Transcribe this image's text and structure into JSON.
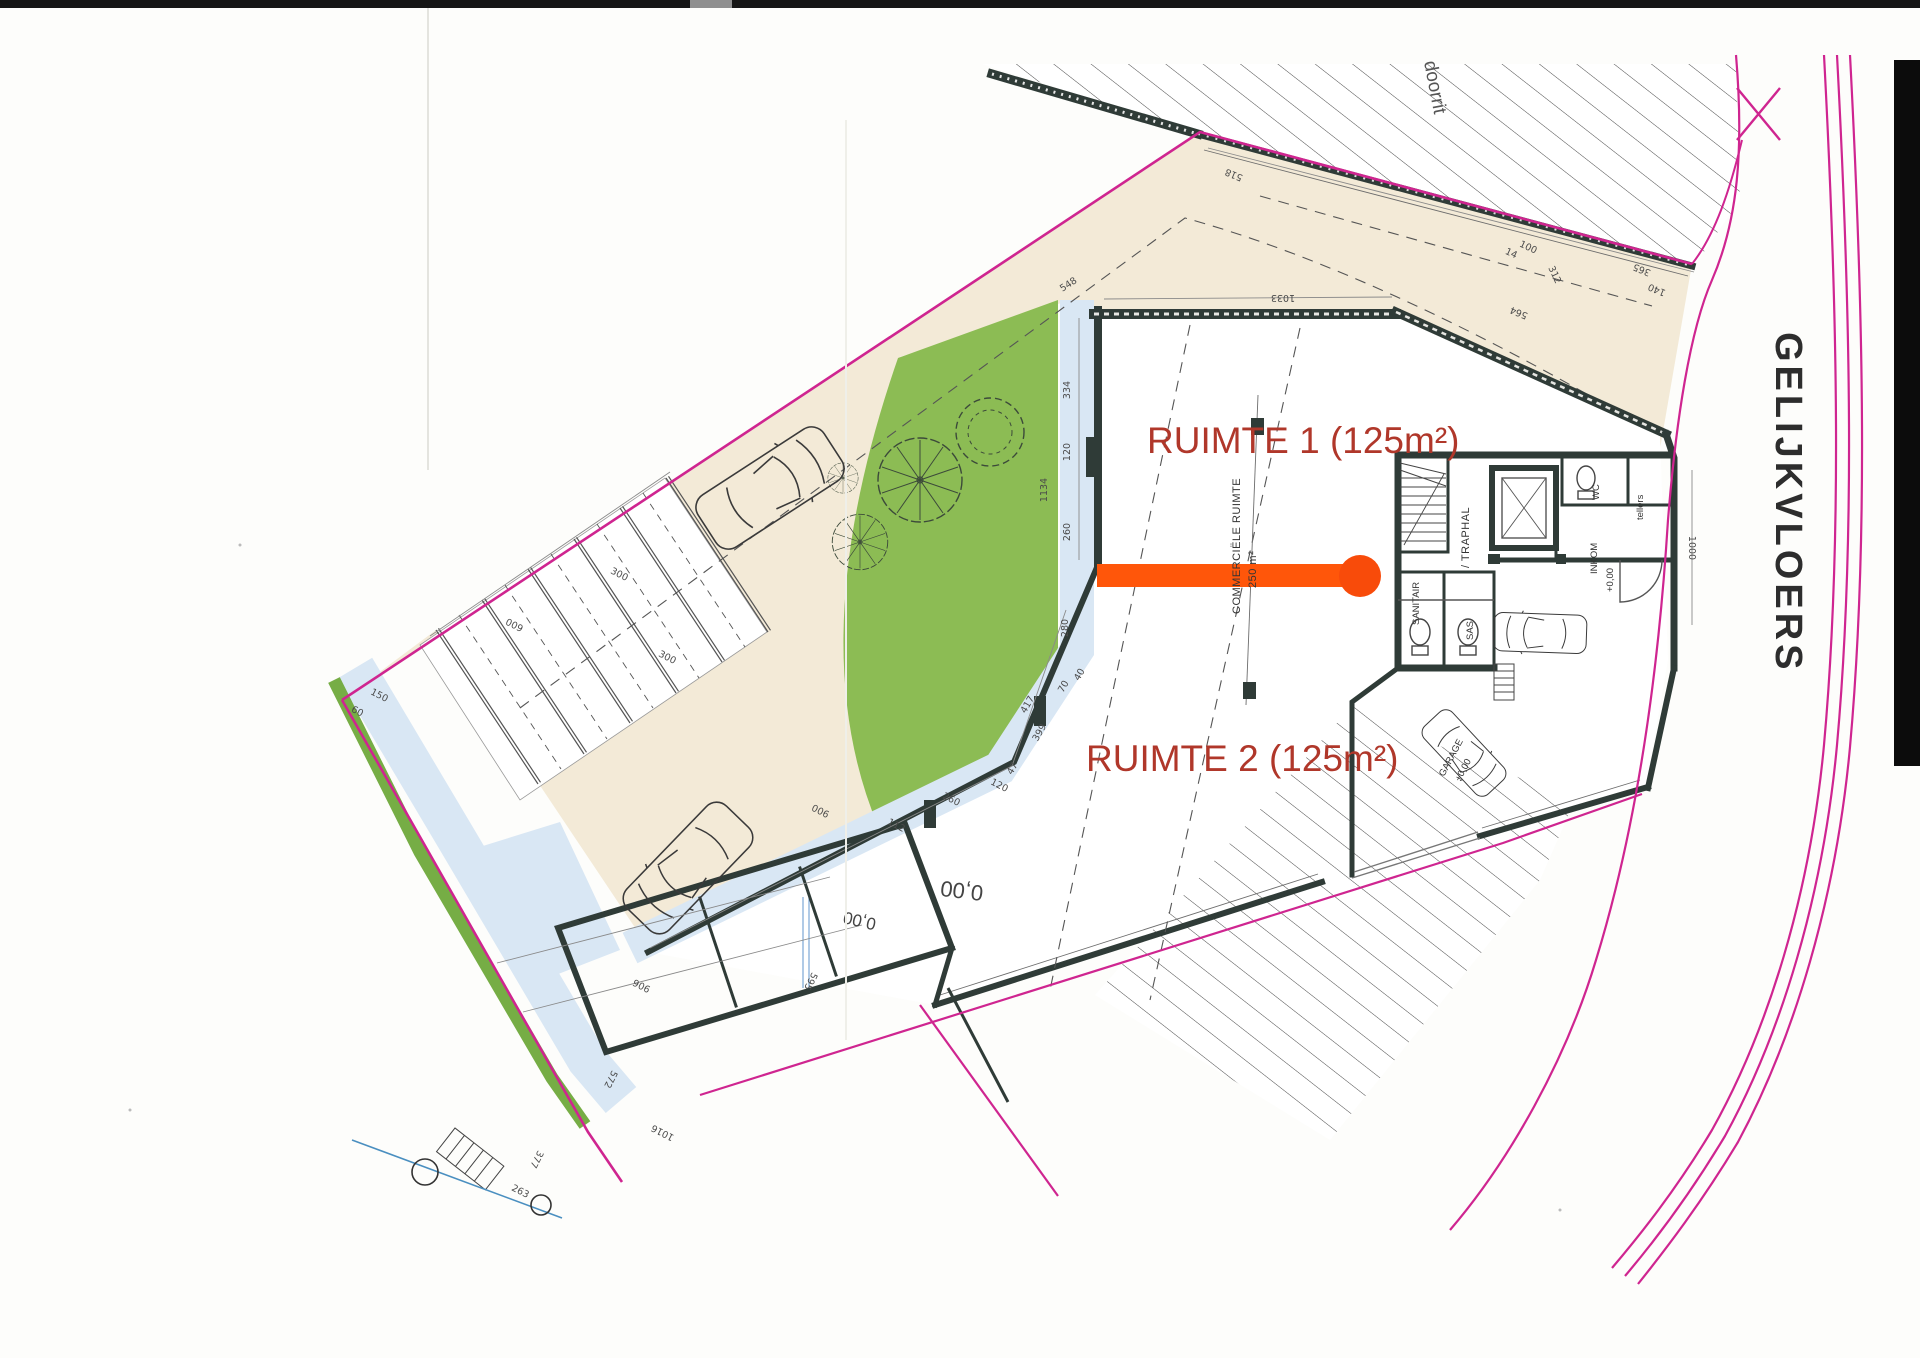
{
  "sheet": {
    "floor_title": "GELIJKVLOERS",
    "driveway_label": "doorrit"
  },
  "spaces": {
    "ruimte1": "RUIMTE 1 (125m²)",
    "ruimte2": "RUIMTE 2 (125m²)",
    "commercial_line1": "COMMERCIËLE RUIMTE",
    "commercial_line2": "250 m²",
    "traphal": "/ TRAPHAL",
    "sanitair": "SANITAIR",
    "sas": "SAS",
    "wc": "WC",
    "inkom": "INKOM",
    "inkom_level": "+0,00",
    "tellers": "tellers",
    "garage": "GARAGE",
    "garage_level": "+0,00",
    "level_rear_main": "0,00",
    "level_rear_small": "0,00"
  },
  "dims": [
    "1033",
    "548",
    "518",
    "100",
    "14",
    "312",
    "564",
    "365",
    "140",
    "1000",
    "334",
    "120",
    "260",
    "1134",
    "280",
    "417",
    "399",
    "40",
    "70",
    "47",
    "120",
    "260",
    "112",
    "600",
    "300",
    "300",
    "150",
    "60",
    "900",
    "906",
    "595",
    "572",
    "1016",
    "377",
    "263"
  ],
  "colors": {
    "boundary_pink": "#cf2590",
    "highlight_orange": "#ff560a",
    "garden_green": "#8cbc54",
    "paving_beige": "#f3ead7",
    "walkway_blue": "#d9e7f4",
    "wall_dark": "#2f3b37",
    "label_red": "#b0372a"
  }
}
